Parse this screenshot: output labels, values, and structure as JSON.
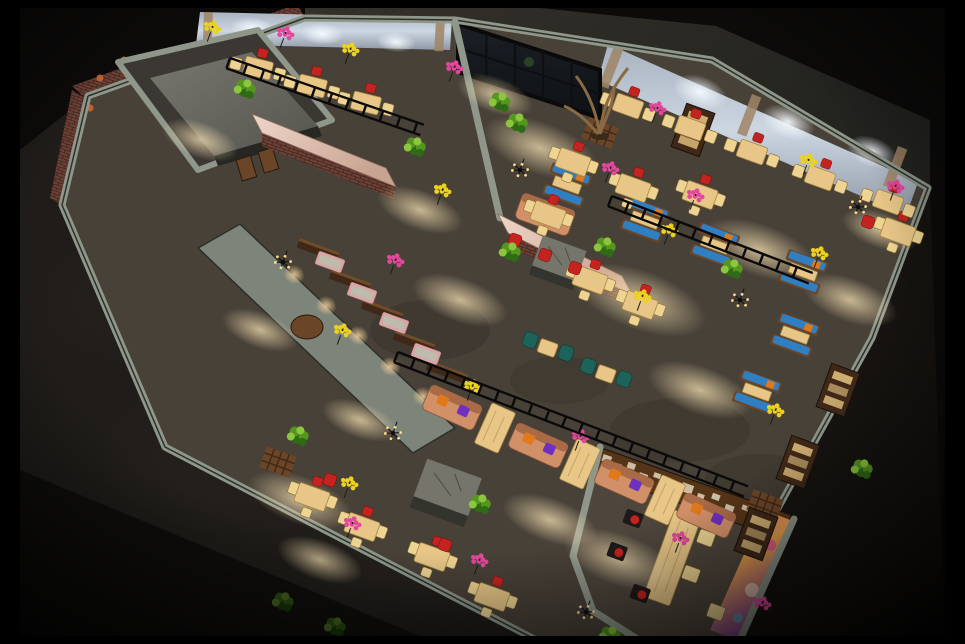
{
  "image": {
    "type": "3d-architectural-render",
    "subject": "restaurant interior",
    "view": "aerial isometric dollhouse cutaway at night",
    "description": "Aerial isometric 3D rendering of a rustic industrial restaurant interior at night: brick and concrete walls, glowing curtained windows, a glass entrance, wooden booths with arched lit niches, tan dining tables with red cushion chairs, peach leather sofas with orange and purple pillows, blue-cushion booths, green plants, yellow and pink flower bouquets, and a private dining room with a colorful mural, framed by a black border."
  },
  "palette": {
    "bg": "#000000",
    "slab": "#24211d",
    "floor": "#51493f",
    "floor_light": "#6b6152",
    "wall_top": "#8f978b",
    "wall_face": "#565b52",
    "ceiling": "#2e2c27",
    "brick": "#6e4136",
    "mortar": "#3a241c",
    "bar_top": "#e3c6b8",
    "wood_dark": "#3f2818",
    "wood_mid": "#6b4527",
    "wood_light": "#9a6a38",
    "table_tan": "#e7c687",
    "table_edge": "#a8853f",
    "chair_tan": "#edd492",
    "cushion_red": "#c32420",
    "sofa_peach": "#d29069",
    "sofa_back": "#a96a48",
    "pillow_orange": "#e0791c",
    "pillow_purple": "#6f2fc0",
    "booth_blue": "#2f7fc2",
    "teal": "#1e635a",
    "plant_dark": "#2f6b17",
    "plant_mid": "#55961f",
    "plant_light": "#8cc63e",
    "flower_yellow": "#ecd11f",
    "flower_pink": "#e2479c",
    "curtain": "#b9c4d2",
    "drape": "#a08566",
    "glow_warm": "#ffd98f",
    "concrete": "#75756c",
    "frame_light": "#d8cdb4",
    "seat_pink": "#d9a6a6"
  },
  "elements": {
    "rooms": [
      "brick utility room",
      "window bar row",
      "entrance lobby",
      "main dining hall",
      "booth corridor",
      "sofa lounge row",
      "private dining room"
    ],
    "features": [
      "black photo border",
      "concrete slab surround",
      "glass entrance doors",
      "glowing sheer curtains",
      "brick bar counter with marble top",
      "driftwood sculpture",
      "arched wall niches",
      "picture-frame wall",
      "graffiti mural",
      "hanging flower chandeliers"
    ]
  },
  "scene": {
    "rails": [
      [
        230,
        58,
        19,
        205
      ],
      [
        398,
        352,
        21,
        375
      ],
      [
        612,
        196,
        21,
        215
      ]
    ],
    "light_pools": [
      [
        540,
        148,
        60,
        26
      ],
      [
        640,
        300,
        70,
        30
      ],
      [
        760,
        250,
        60,
        26
      ],
      [
        460,
        300,
        50,
        22
      ],
      [
        300,
        500,
        55,
        24
      ],
      [
        620,
        560,
        60,
        26
      ],
      [
        700,
        390,
        55,
        24
      ],
      [
        200,
        140,
        40,
        18
      ],
      [
        850,
        300,
        50,
        22
      ],
      [
        420,
        210,
        45,
        20
      ],
      [
        550,
        520,
        50,
        22
      ],
      [
        880,
        230,
        40,
        18
      ],
      [
        320,
        560,
        45,
        20
      ],
      [
        260,
        330,
        40,
        18
      ],
      [
        360,
        420,
        40,
        18
      ],
      [
        495,
        95,
        40,
        18
      ]
    ],
    "columns": [
      [
        446,
        492,
        20,
        1
      ],
      [
        558,
        262,
        20,
        0.8
      ]
    ],
    "arch_niches": [
      [
        294,
        275
      ],
      [
        326,
        306
      ],
      [
        358,
        336
      ],
      [
        390,
        367
      ],
      [
        423,
        397
      ]
    ],
    "partitions": [
      [
        318,
        250
      ],
      [
        350,
        281
      ],
      [
        382,
        311
      ],
      [
        414,
        342
      ],
      [
        447,
        372
      ]
    ],
    "pink_seats": [
      [
        330,
        262
      ],
      [
        362,
        293
      ],
      [
        394,
        323
      ],
      [
        426,
        354
      ]
    ],
    "lattices": [
      [
        278,
        462
      ],
      [
        600,
        133
      ],
      [
        765,
        505
      ]
    ],
    "cabinets": [
      [
        838,
        390
      ],
      [
        798,
        462
      ],
      [
        756,
        534
      ],
      [
        693,
        130
      ]
    ],
    "booths_blue": [
      [
        645,
        220
      ],
      [
        715,
        245
      ],
      [
        803,
        272
      ],
      [
        795,
        335
      ],
      [
        757,
        392
      ],
      [
        567,
        185
      ]
    ],
    "sofas_peach": [
      [
        452,
        408,
        24
      ],
      [
        538,
        446,
        24
      ],
      [
        624,
        482,
        24
      ],
      [
        706,
        516,
        24
      ],
      [
        545,
        215,
        20
      ]
    ],
    "sofa_tables": [
      [
        495,
        428,
        24
      ],
      [
        580,
        464,
        24
      ],
      [
        665,
        500,
        24
      ]
    ],
    "hall_tables": [
      [
        573,
        162
      ],
      [
        633,
        188
      ],
      [
        548,
        215
      ],
      [
        590,
        280
      ],
      [
        640,
        305
      ],
      [
        898,
        232
      ],
      [
        312,
        497
      ],
      [
        362,
        527
      ],
      [
        432,
        557
      ],
      [
        492,
        597
      ],
      [
        700,
        195
      ]
    ],
    "window_tables": [
      [
        628,
        106,
        20
      ],
      [
        690,
        128,
        20
      ],
      [
        752,
        152,
        20
      ],
      [
        820,
        178,
        20
      ],
      [
        888,
        202,
        20
      ],
      [
        258,
        68,
        14
      ],
      [
        312,
        86,
        14
      ],
      [
        366,
        103,
        14
      ]
    ],
    "teal_pairs": [
      [
        548,
        347
      ],
      [
        606,
        373
      ]
    ],
    "private_chairs_dark": [
      [
        633,
        519
      ],
      [
        617,
        552
      ],
      [
        640,
        594
      ]
    ],
    "private_chairs_tan": [
      [
        706,
        538
      ],
      [
        691,
        574
      ],
      [
        716,
        612
      ]
    ],
    "red_seats": [
      [
        868,
        222
      ],
      [
        445,
        545
      ],
      [
        330,
        480
      ],
      [
        515,
        240
      ],
      [
        545,
        255
      ],
      [
        575,
        268
      ]
    ],
    "plants": [
      [
        510,
        253
      ],
      [
        732,
        270
      ],
      [
        298,
        437
      ],
      [
        335,
        628
      ],
      [
        610,
        637
      ],
      [
        500,
        103
      ],
      [
        517,
        124
      ],
      [
        862,
        470
      ],
      [
        415,
        148
      ],
      [
        605,
        248
      ],
      [
        283,
        603
      ],
      [
        245,
        90
      ],
      [
        480,
        505
      ]
    ],
    "flowers_yellow": [
      [
        210,
        34
      ],
      [
        348,
        56
      ],
      [
        440,
        197
      ],
      [
        347,
        490
      ],
      [
        470,
        393
      ],
      [
        806,
        167
      ],
      [
        667,
        237
      ],
      [
        773,
        417
      ],
      [
        640,
        303
      ],
      [
        817,
        260
      ],
      [
        340,
        337
      ]
    ],
    "flowers_pink": [
      [
        283,
        40
      ],
      [
        452,
        74
      ],
      [
        655,
        115
      ],
      [
        893,
        193
      ],
      [
        393,
        267
      ],
      [
        350,
        530
      ],
      [
        477,
        567
      ],
      [
        578,
        443
      ],
      [
        678,
        545
      ],
      [
        760,
        610
      ],
      [
        608,
        175
      ],
      [
        693,
        202
      ]
    ],
    "chandeliers": [
      [
        520,
        170
      ],
      [
        283,
        262
      ],
      [
        393,
        433
      ],
      [
        858,
        207
      ],
      [
        740,
        300
      ],
      [
        586,
        612
      ]
    ]
  }
}
